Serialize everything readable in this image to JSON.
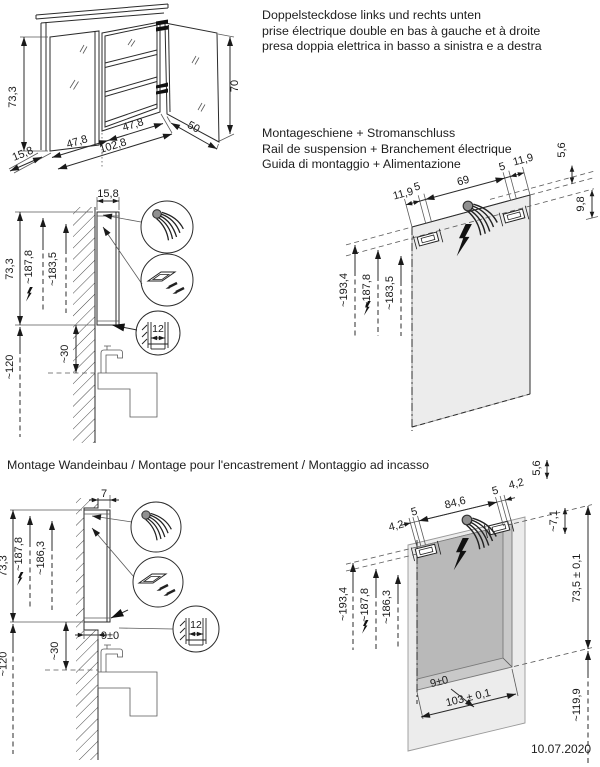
{
  "page": {
    "date": "10.07.2020"
  },
  "notes": {
    "sockets": {
      "de": "Doppelsteckdose links und rechts unten",
      "fr": "prise électrique double en bas à gauche et à droite",
      "it": "presa doppia elettrica in basso a sinistra e a destra"
    },
    "rail": {
      "de": "Montageschiene + Stromanschluss",
      "fr": "Rail de suspension + Branchement électrique",
      "it": "Guida di montaggio + Alimentazione"
    },
    "recess_heading": "Montage Wandeinbau / Montage pour l'encastrement / Montaggio ad incasso"
  },
  "cabinet_iso": {
    "height_left": "73,3",
    "depth": "15,8",
    "door_left": "47,8",
    "total_width": "102,8",
    "inner_width": "47,8",
    "door_right": "50",
    "height_right": "70"
  },
  "surface_side": {
    "depth": "15,8",
    "height": "73,3",
    "h_power": "~187,8",
    "h_rail": "~183,5",
    "h_floor": "~120",
    "h_basin": "~30",
    "rail_detail": "12"
  },
  "surface_front": {
    "d1": "11,9",
    "d2": "5",
    "d3": "69",
    "d4": "5",
    "d5": "11,9",
    "top_offset": "5,6",
    "rail_offset": "9,8",
    "h_top": "~193,4",
    "h_power": "~187,8",
    "h_rail": "~183,5"
  },
  "recess_side": {
    "depth": "7",
    "height": "73,3",
    "h_power": "~187,8",
    "h_rail": "~186,3",
    "h_floor": "~120",
    "h_basin": "~30",
    "niche_depth": "9±0",
    "rail_detail": "12"
  },
  "recess_front": {
    "d1": "4,2",
    "d2": "5",
    "d3": "84,6",
    "d4": "5",
    "d5": "4,2",
    "top_offset": "5,6",
    "edge_offset": "~7,1",
    "niche_height": "73,5 ± 0,1",
    "h_top": "~193,4",
    "h_power": "~187,8",
    "h_rail": "~186,3",
    "h_bottom": "~119,9",
    "niche_depth": "9±0",
    "niche_width": "103 ± 0,1"
  }
}
